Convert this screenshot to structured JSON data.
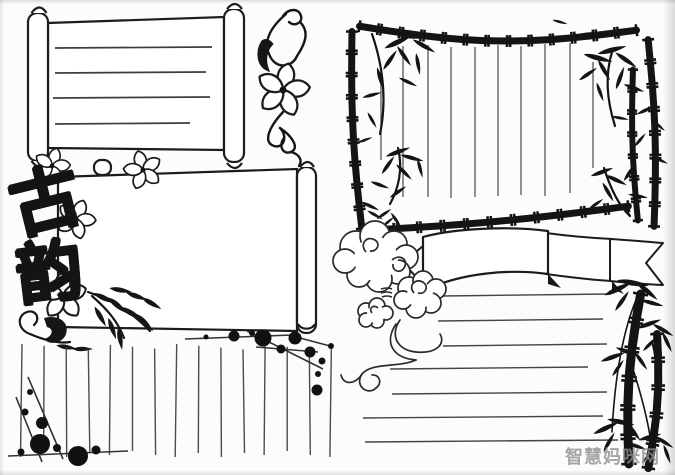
{
  "image": {
    "description": "Two hand-drawn blank handwritten-newspaper page templates, black ink on white paper",
    "ink_color": "#161616",
    "paper_color": "#fcfcfb"
  },
  "left_page": {
    "title_calligraphy": "古韵",
    "title_chars": [
      "古",
      "韵"
    ],
    "top_scroll_writing_lines": 4,
    "second_scroll_writing_lines": 0,
    "bottom_vertical_writing_lines": 15
  },
  "right_page": {
    "frame_vertical_writing_lines": 10,
    "bottom_horizontal_writing_lines": 7,
    "ribbon_text": ""
  },
  "watermark": {
    "text": "智慧妈咪网",
    "color": "#8f8f8f"
  }
}
